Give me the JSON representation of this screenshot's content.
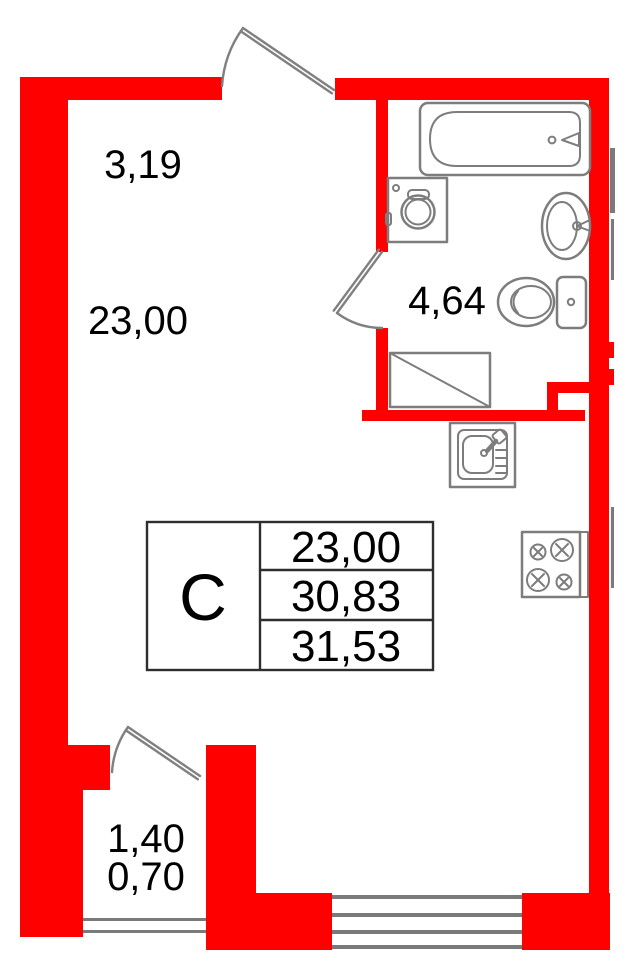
{
  "plan": {
    "dimensions": {
      "main_room": {
        "width": "3,19",
        "area": "23,00"
      },
      "bathroom": {
        "area": "4,64"
      },
      "balcony": {
        "width": "1,40",
        "area": "0,70"
      }
    },
    "stamp": {
      "letter": "С",
      "values": [
        "23,00",
        "30,83",
        "31,53"
      ]
    },
    "colors": {
      "wall": "#ff0000",
      "fixture": "#7d7d7d",
      "door": "#808080",
      "window": "#7a7a7a",
      "stamp_line": "#2e2e2e",
      "text": "#000000"
    },
    "icons": [
      "entrance-door-swing-icon",
      "bathroom-door-swing-icon",
      "balcony-door-swing-icon",
      "bathtub-icon",
      "washing-machine-icon",
      "washbasin-icon",
      "toilet-icon",
      "shower-tray-icon",
      "kitchen-sink-icon",
      "stove-icon",
      "window-icon",
      "balcony-glazing-icon"
    ]
  }
}
